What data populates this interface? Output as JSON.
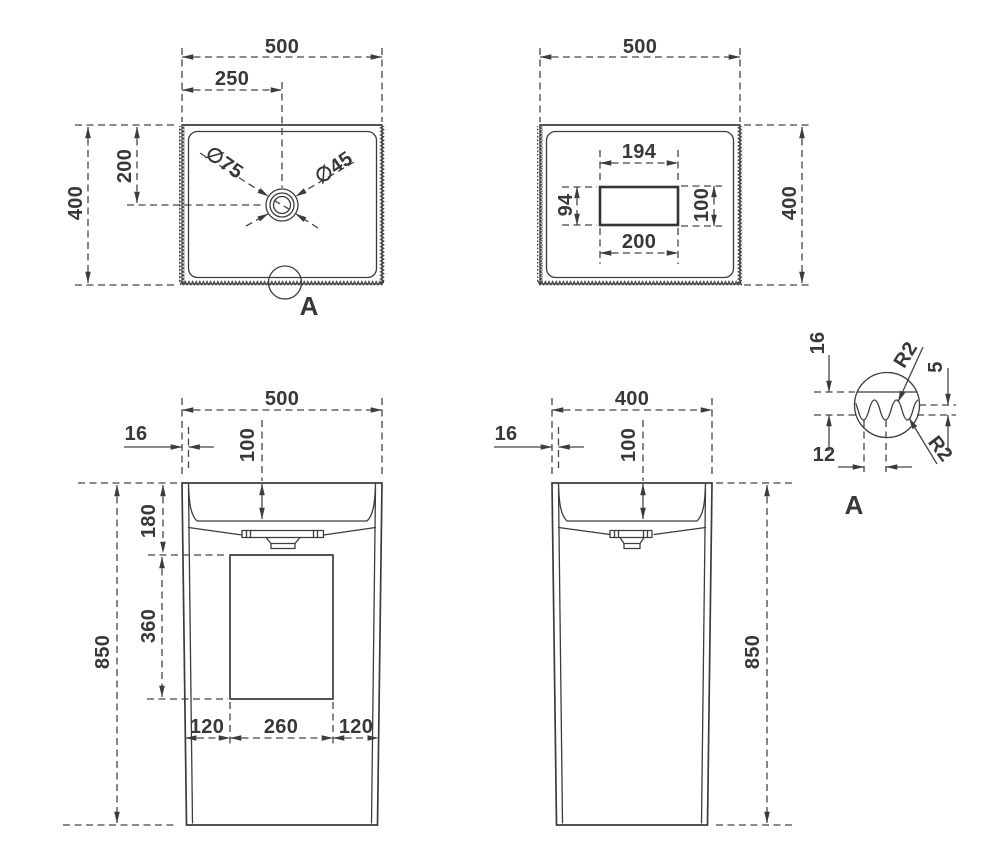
{
  "labels": {
    "plan": {
      "width": "500",
      "center_x": "250",
      "depth": "400",
      "center_y": "200",
      "drain_outer": "∅75",
      "drain_inner": "∅45",
      "detail_ref": "A"
    },
    "bottom_view": {
      "width": "500",
      "opening_top": "194",
      "opening_bottom": "200",
      "opening_left": "94",
      "opening_right": "100",
      "depth": "400"
    },
    "front": {
      "width": "500",
      "wall": "16",
      "bowl_depth": "100",
      "rim_to_opening": "180",
      "opening_height": "360",
      "height": "850",
      "bottom_left": "120",
      "bottom_center": "260",
      "bottom_right": "120"
    },
    "side": {
      "width": "400",
      "wall": "16",
      "bowl_depth": "100",
      "height": "850"
    },
    "detail": {
      "title": "A",
      "wall": "16",
      "texture_depth": "5",
      "pitch": "12",
      "radius_1": "R2",
      "radius_2": "R2"
    }
  }
}
